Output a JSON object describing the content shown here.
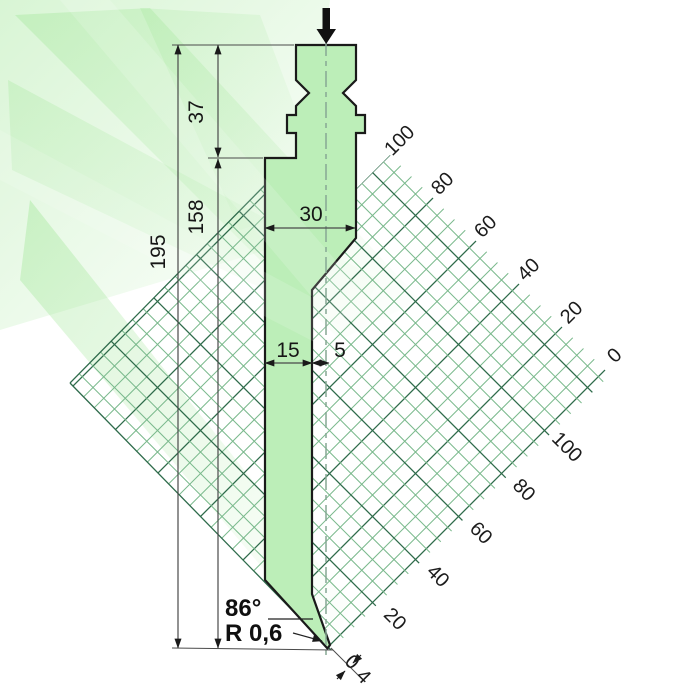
{
  "drawing": {
    "dims": {
      "total_height": "195",
      "shank_height": "37",
      "body_height": "158",
      "body_width": "30",
      "blade_width": "15",
      "tip_offset": "5",
      "tip_angle": "86°",
      "tip_radius": "R 0,6",
      "tip_flat": "4"
    },
    "scales": {
      "upper": [
        "100",
        "80",
        "60",
        "40",
        "20",
        "0"
      ],
      "lower": [
        "100",
        "80",
        "60",
        "40",
        "20",
        "0"
      ]
    },
    "colors": {
      "tool_fill": "#bceeb8",
      "outline": "#1a1a1a",
      "grid_minor": "#7ab98c",
      "grid_major": "#2e6b4b",
      "glow": "#98e48e",
      "dim_line": "#4a4a4a"
    }
  }
}
